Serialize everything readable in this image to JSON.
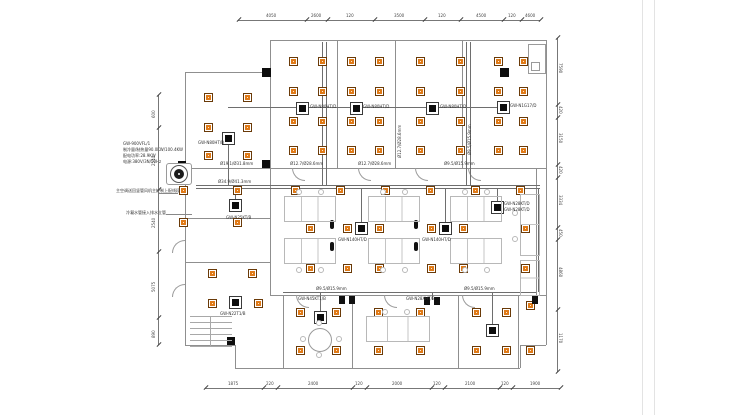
{
  "drawing": {
    "type": "HVAC ceiling plan with square diffusers and cassette indoor units",
    "colors": {
      "diffuser_fill": "#e07a17",
      "diffuser_border": "#6a3a08",
      "wall_line": "#8f8f8f",
      "pipe_line": "#6e6e6e",
      "unit_fill": "#0d0d0d"
    }
  },
  "ann": [
    "GW-900VFL/1",
    "制冷量/制热量90.0KW/100.4KW",
    "配电功率:28.9KW",
    "电源:380V/3N/50Hz"
  ],
  "notes": [
    "主空调送回竖管风机主控制上配线段",
    "冷凝水管接入排水立管"
  ],
  "units": [
    "GW-N80HT/B",
    "GW-N80HT/D",
    "GW-N80HT/D",
    "GW-N80HT/D",
    "GW-N1G17/D",
    "GW-N25KT/B",
    "GW-N140HT/D",
    "GW-N140HT/D",
    "GW-N28KT/D",
    "GW-N28KT/D",
    "GW-N22T1/B",
    "GW-N45KT1/B",
    "GW-N28XHT/B"
  ],
  "pipes": [
    "Ø19.1/Ø31.8mm",
    "Ø12.7/Ø28.6mm",
    "Ø12.7/Ø28.6mm",
    "Ø9.5/Ø15.9mm",
    "Ø34.9/Ø41.3mm",
    "Ø9.5/Ø15.9mm",
    "Ø9.5/Ø15.9mm",
    "Ø9.5/Ø15.9mm",
    "Ø12.7/Ø28.6mm"
  ],
  "dims": {
    "top": [
      "4050",
      "2600",
      "120",
      "3500",
      "120",
      "4500",
      "120",
      "4600"
    ],
    "bottom": [
      "1875",
      "220",
      "2400",
      "120",
      "2000",
      "120",
      "2100",
      "120",
      "1900"
    ],
    "left": [
      "600",
      "2540",
      "2540",
      "5075",
      "890"
    ],
    "right": [
      "7590",
      "420",
      "3150",
      "420",
      "3334",
      "450",
      "4860",
      "1170"
    ]
  }
}
